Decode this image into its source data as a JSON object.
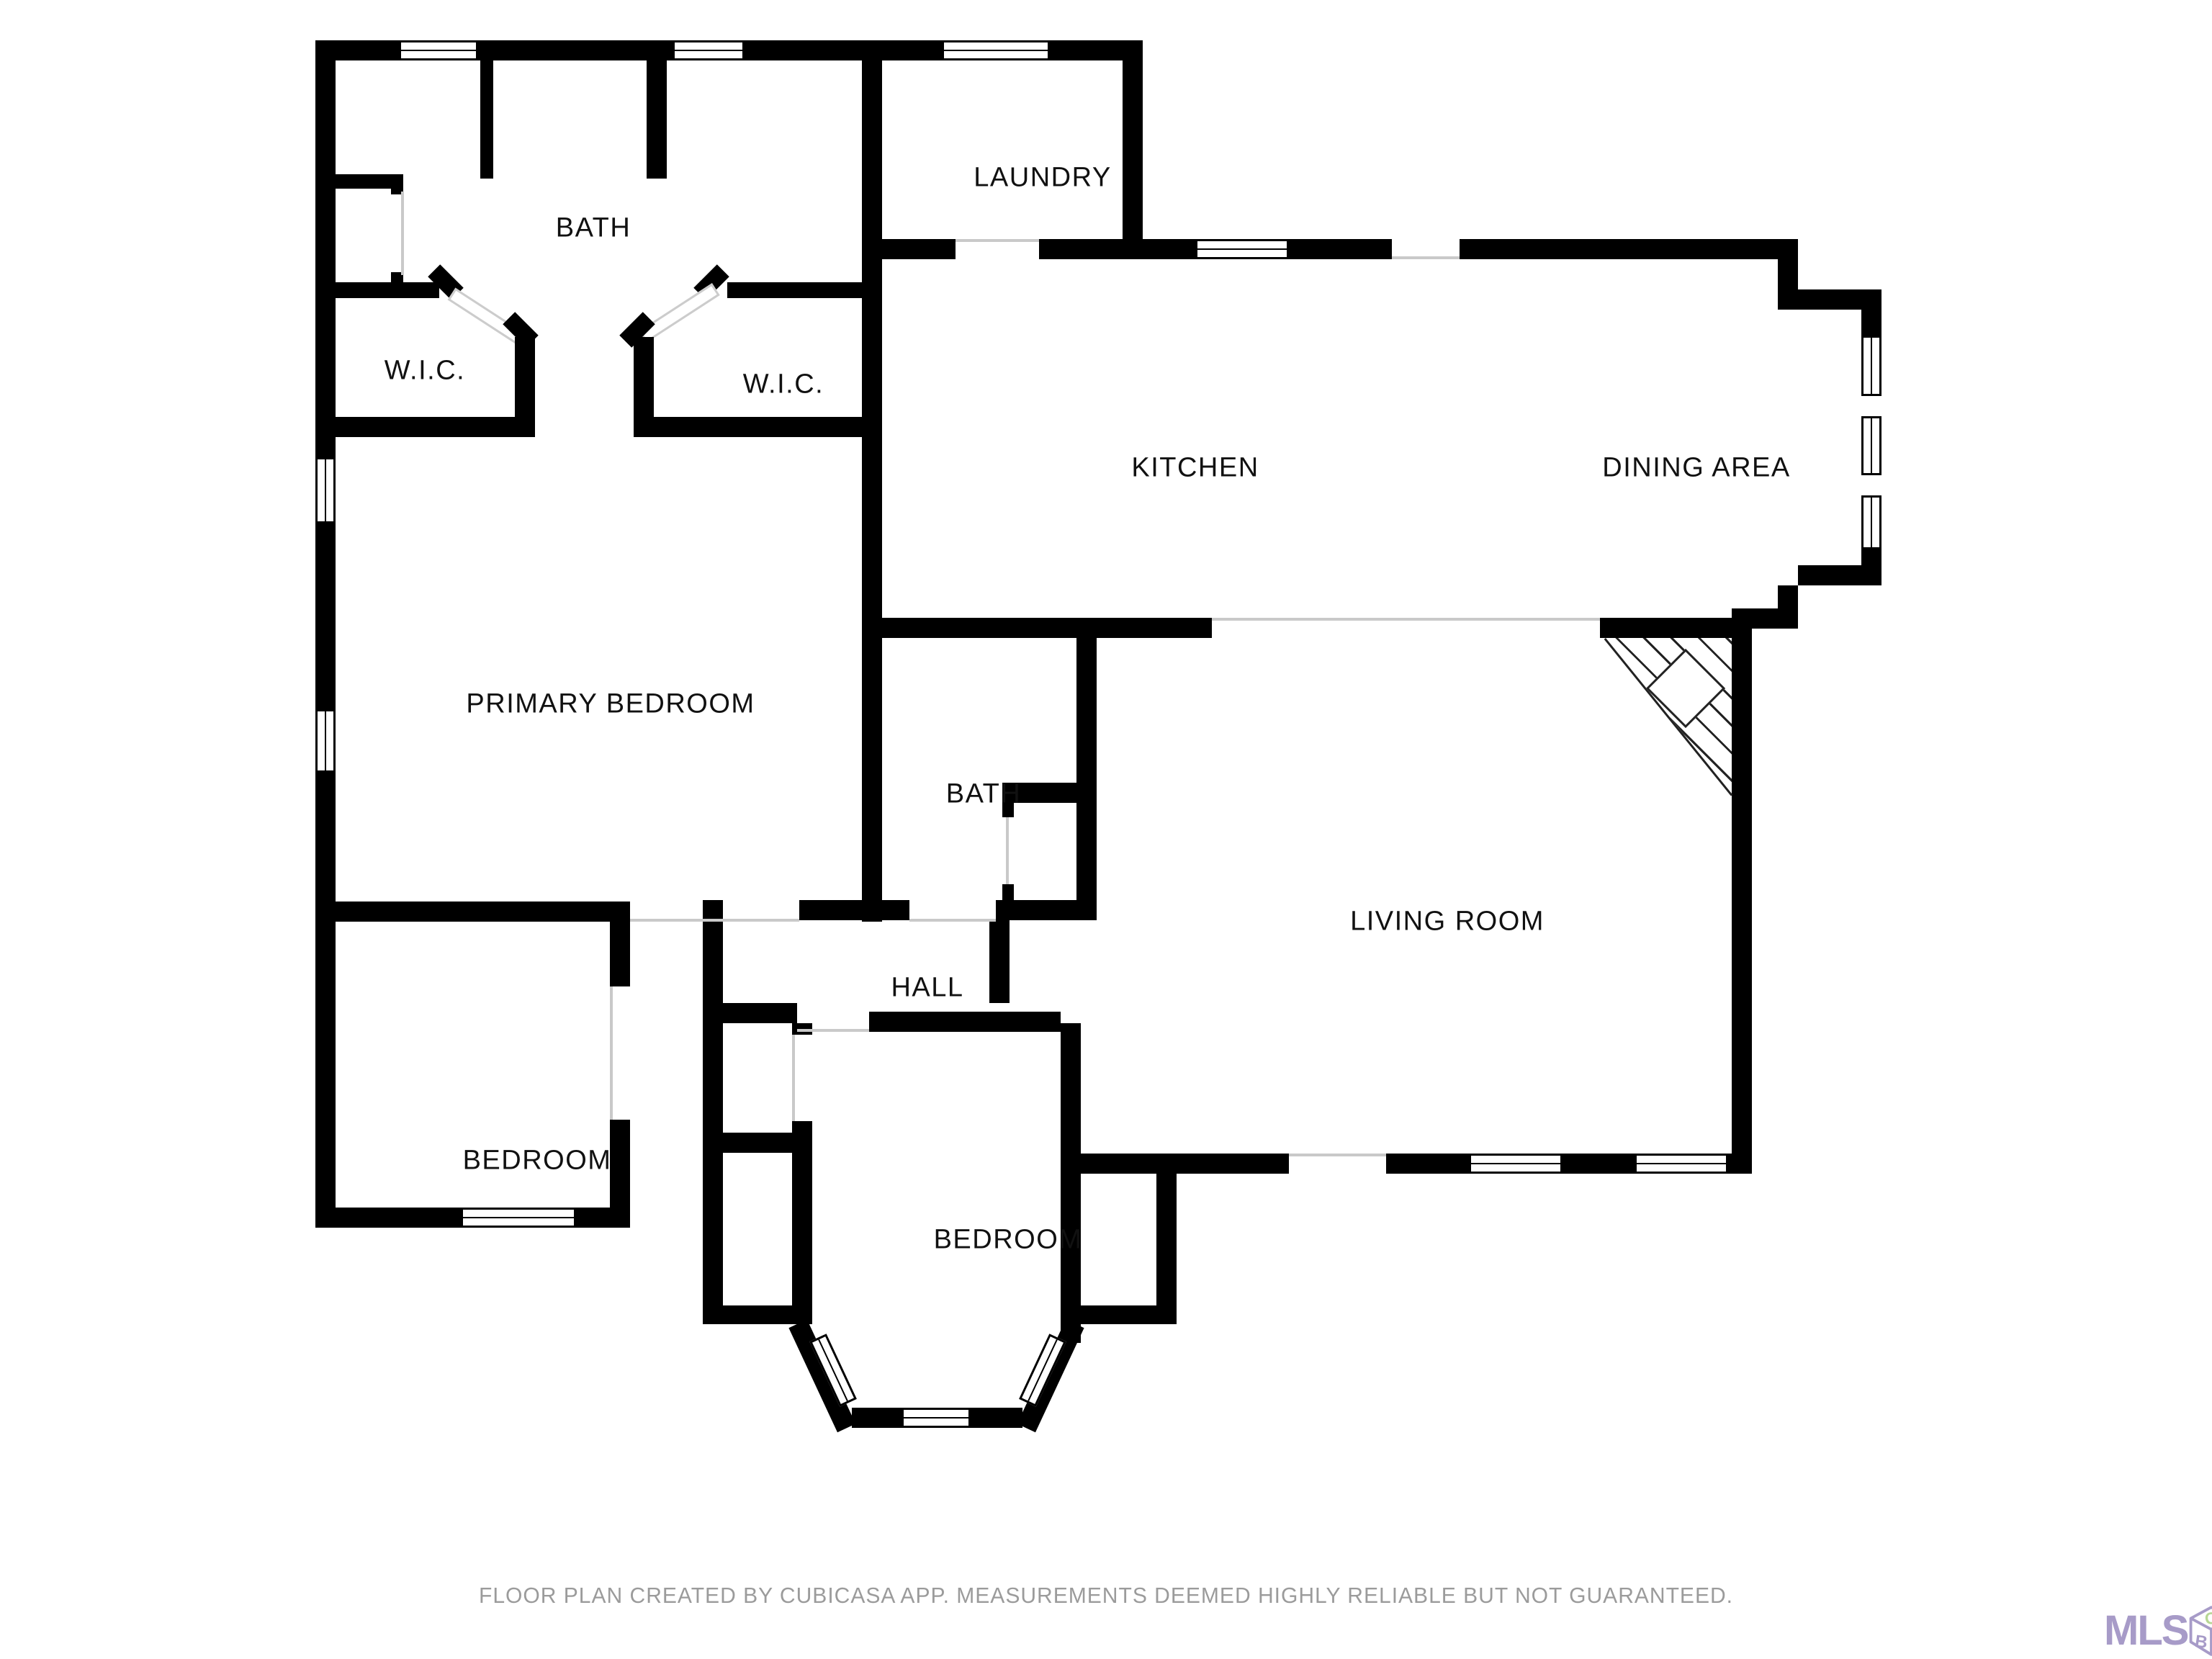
{
  "plan": {
    "rooms": [
      {
        "name": "bath-primary",
        "label": "BATH"
      },
      {
        "name": "laundry",
        "label": "LAUNDRY"
      },
      {
        "name": "wic-left",
        "label": "W.I.C."
      },
      {
        "name": "wic-right",
        "label": "W.I.C."
      },
      {
        "name": "kitchen",
        "label": "KITCHEN"
      },
      {
        "name": "dining-area",
        "label": "DINING AREA"
      },
      {
        "name": "primary-bedroom",
        "label": "PRIMARY BEDROOM"
      },
      {
        "name": "bath-hall",
        "label": "BATH"
      },
      {
        "name": "hall",
        "label": "HALL"
      },
      {
        "name": "living-room",
        "label": "LIVING ROOM"
      },
      {
        "name": "bedroom-left",
        "label": "BEDROOM"
      },
      {
        "name": "bedroom-bottom",
        "label": "BEDROOM"
      }
    ]
  },
  "footer": {
    "caption": "FLOOR PLAN CREATED BY CUBICASA APP. MEASUREMENTS DEEMED HIGHLY RELIABLE BUT NOT GUARANTEED."
  },
  "logo": {
    "text": "MLS",
    "cube_letters": {
      "top": "O",
      "left": "B",
      "right": "X"
    }
  },
  "colors": {
    "wall": "#000000",
    "caption_gray": "#9b9b9b",
    "logo_purple": "#a79bc8",
    "logo_green": "#b7d795"
  }
}
